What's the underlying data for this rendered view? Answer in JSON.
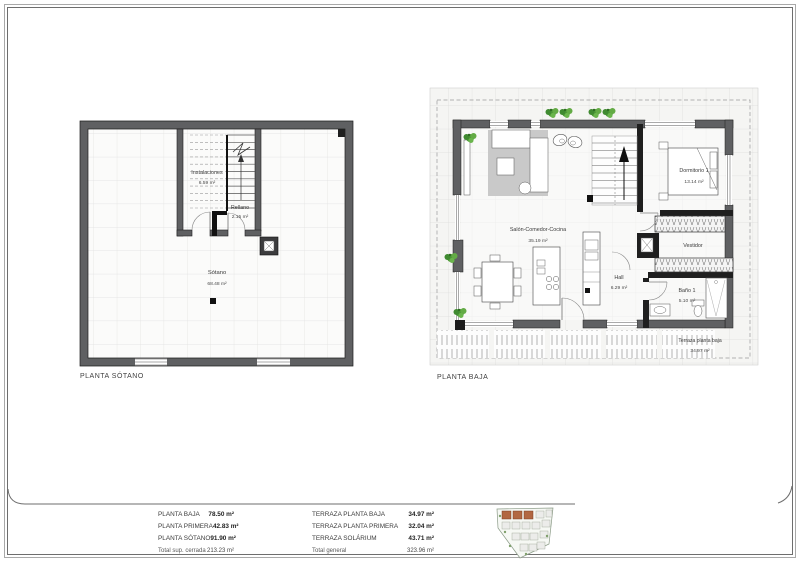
{
  "plans": {
    "basement": {
      "title": "PLANTA SÓTANO",
      "rooms": {
        "instalaciones": {
          "name": "Instalaciones",
          "area": "6.59 m²"
        },
        "rellano": {
          "name": "Rellano",
          "area": "2.15 m²"
        },
        "sotano": {
          "name": "Sótano",
          "area": "68.48 m²"
        }
      }
    },
    "ground": {
      "title": "PLANTA BAJA",
      "rooms": {
        "salon": {
          "name": "Salón-Comedor-Cocina",
          "area": "35.19 m²"
        },
        "hall": {
          "name": "Hall",
          "area": "6.29 m²"
        },
        "dormitorio": {
          "name": "Dormitorio 1",
          "area": "13.14 m²"
        },
        "vestidor": {
          "name": "Vestidor"
        },
        "bano": {
          "name": "Baño 1",
          "area": "5.10 m²"
        },
        "terraza": {
          "name": "Terraza planta baja",
          "area": "34.97 m²"
        }
      }
    }
  },
  "areas_table": {
    "closed": {
      "rows": [
        {
          "label": "PLANTA BAJA",
          "value": "78.50 m²"
        },
        {
          "label": "PLANTA PRIMERA",
          "value": "42.83 m²"
        },
        {
          "label": "PLANTA SÓTANO",
          "value": "91.90 m²"
        }
      ],
      "total": {
        "label": "Total sup. cerrada",
        "value": "213.23 m²"
      }
    },
    "terraces": {
      "rows": [
        {
          "label": "TERRAZA PLANTA BAJA",
          "value": "34.97 m²"
        },
        {
          "label": "TERRAZA PLANTA PRIMERA",
          "value": "32.04 m²"
        },
        {
          "label": "TERRAZA SOLÁRIUM",
          "value": "43.71 m²"
        }
      ],
      "total": {
        "label": "Total general",
        "value": "323.96 m²"
      }
    }
  },
  "colors": {
    "wall": "#5f6062",
    "highlight_units": "#b26742",
    "plant": "#4f9a38",
    "rug": "#c9c9c9"
  }
}
